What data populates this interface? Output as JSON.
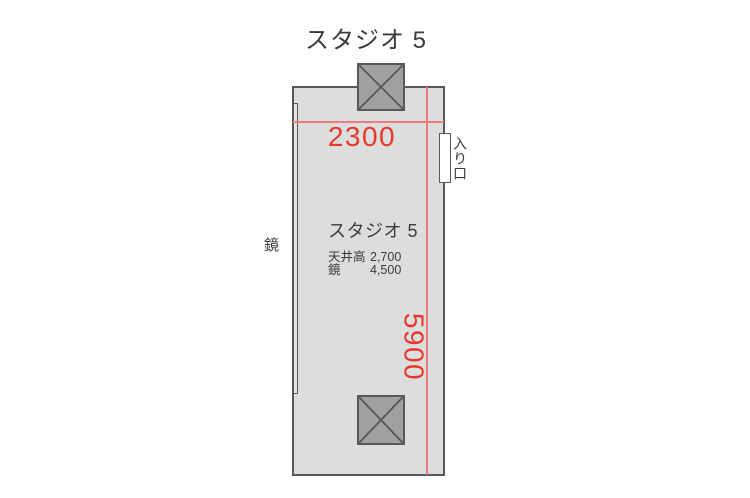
{
  "diagram_title": "スタジオ 5",
  "floorplan": {
    "room_name": "スタジオ 5",
    "dimensions": {
      "width_mm": "2300",
      "depth_mm": "5900"
    },
    "specs": [
      {
        "label": "天井高",
        "value": "2,700"
      },
      {
        "label": "鏡",
        "value": "4,500"
      }
    ],
    "entrance_label": "入り口",
    "mirror_label": "鏡"
  },
  "colors": {
    "room_fill": "#dcdddd",
    "outline_dark": "#595757",
    "pillar_fill": "#9fa0a0",
    "text_dark": "#3f3a39",
    "dimension_text_red": "#e8382d",
    "dimension_line_red": "#ee7b82"
  }
}
